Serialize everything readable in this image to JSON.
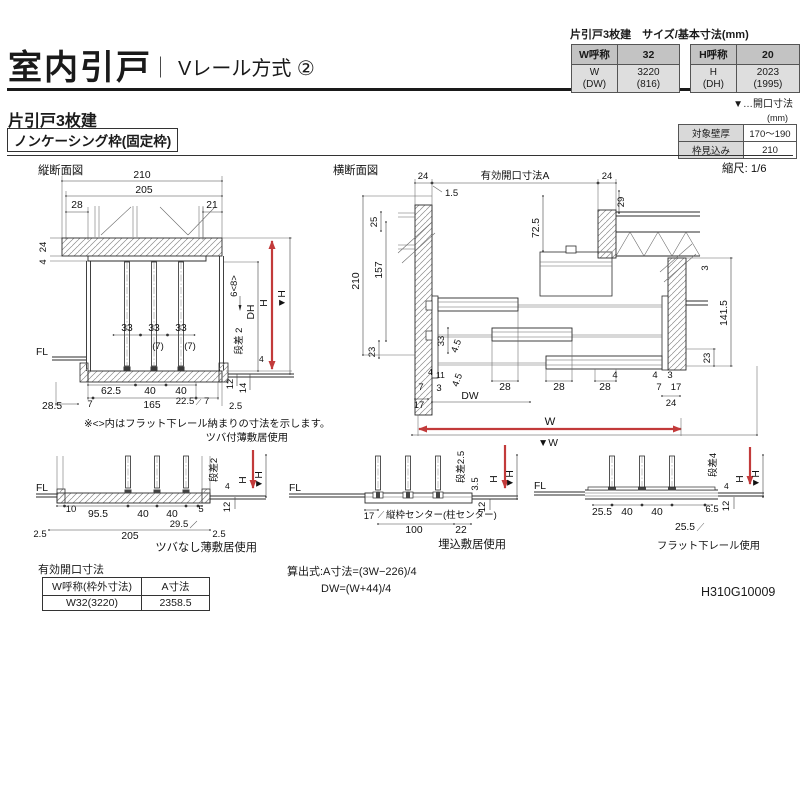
{
  "colors": {
    "accent_red": "#c23a3a",
    "line": "#2b2b2b"
  },
  "header": {
    "title": "室内引戸",
    "divider": "｜",
    "subtitle": "Vレール方式 ②"
  },
  "size_table": {
    "caption": "片引戸3枚建　サイズ/基本寸法(mm)",
    "w_label": "W呼称",
    "w_val": "32",
    "h_label": "H呼称",
    "h_val": "20",
    "w2_label": "W\n(DW)",
    "w2_val": "3220\n(816)",
    "h2_label": "H\n(DH)",
    "h2_val": "2023\n(1995)",
    "legend": "▼…開口寸法"
  },
  "section": {
    "heading": "片引戸3枚建",
    "frame": "ノンケーシング枠(固定枠)",
    "unit": "(mm)",
    "wall_label": "対象壁厚",
    "wall_val": "170～190",
    "depth_label": "枠見込み",
    "depth_val": "210",
    "scale": "縮尺: 1/6"
  },
  "vs": {
    "title": "縦断面図",
    "d210": "210",
    "d205": "205",
    "d28": "28",
    "d21": "21",
    "d24": "24",
    "d4a": "4",
    "d33a": "33",
    "d33b": "33",
    "d33c": "33",
    "p7a": "(7)",
    "p7b": "(7)",
    "fl": "FL",
    "d62_5": "62.5",
    "d40a": "40",
    "d40b": "40",
    "d7a": "7",
    "d165": "165",
    "d22_5": "22.5",
    "d7b": "7",
    "d28_5": "28.5",
    "d2_5": "2.5",
    "d6_8": "6<8>",
    "dh": "DH",
    "h": "H",
    "hv": "▼H",
    "step": "段差 2",
    "d4b": "4",
    "d12": "12",
    "d14": "14",
    "note1": "※<>内はフラット下レール納まりの寸法を示します。",
    "note2": "ツバ付薄敷居使用"
  },
  "hs": {
    "title": "横断面図",
    "d24l": "24",
    "openA": "有効開口寸法A",
    "d24r": "24",
    "d1_5": "1.5",
    "d29": "29",
    "d25": "25",
    "d210": "210",
    "d157": "157",
    "d23l": "23",
    "d72_5": "72.5",
    "d9_4": "9.4",
    "d1": "1",
    "d33": "33",
    "d4_5a": "4.5",
    "d4_5b": "4.5",
    "d4a": "4",
    "d11": "11",
    "d7l": "7",
    "d3l": "3",
    "d17l": "17",
    "dw": "DW",
    "d28a": "28",
    "d28b": "28",
    "d28c": "28",
    "d4b": "4",
    "d4c": "4",
    "d3r": "3",
    "d7r": "7",
    "d17r": "17",
    "d24b": "24",
    "d3tr": "3",
    "d141_5": "141.5",
    "d23r": "23",
    "w": "W",
    "wv": "▼W"
  },
  "det1": {
    "arrow_label": "ツバ付薄敷居使用",
    "fl": "FL",
    "d10": "10",
    "d95_5": "95.5",
    "d40a": "40",
    "d40b": "40",
    "d5": "5",
    "d29_5": "29.5",
    "d205": "205",
    "d2_5l": "2.5",
    "d2_5r": "2.5",
    "step": "段差2",
    "d4": "4",
    "h": "H",
    "hv": "▼H",
    "d12": "12",
    "caption": "ツバなし薄敷居使用"
  },
  "det2": {
    "fl": "FL",
    "d17": "17",
    "center": "縦枠センター(柱センター)",
    "d100": "100",
    "d22": "22",
    "step": "段差2.5",
    "d3_5": "3.5",
    "h": "H",
    "hv": "▼H",
    "d12": "12",
    "caption": "埋込敷居使用"
  },
  "det3": {
    "fl": "FL",
    "d25_5a": "25.5",
    "d40a": "40",
    "d40b": "40",
    "d6_5": "6.5",
    "d25_5b": "25.5",
    "step": "段差4",
    "d4": "4",
    "h": "H",
    "hv": "▼H",
    "d12": "12",
    "caption": "フラット下レール使用"
  },
  "opening": {
    "caption": "有効開口寸法",
    "col1": "W呼称(枠外寸法)",
    "col2": "A寸法",
    "val1": "W32(3220)",
    "val2": "2358.5"
  },
  "formula": {
    "line1": "算出式:A寸法=(3W−226)/4",
    "line2": "DW=(W+44)/4"
  },
  "footer": {
    "doc": "H310G10009"
  }
}
